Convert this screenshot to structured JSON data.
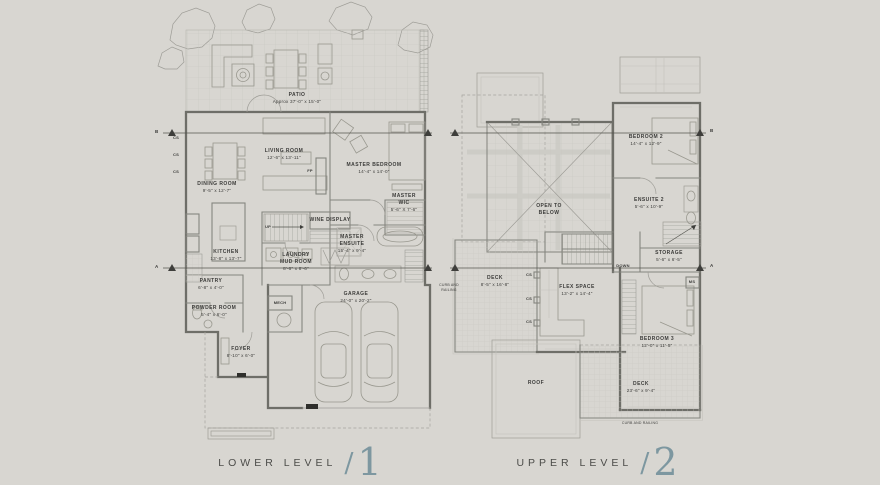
{
  "colors": {
    "background": "#d8d6d1",
    "accent": "#7d97a0",
    "ink": "#3c3c3a",
    "wall": "#6e6e68"
  },
  "titles": {
    "lower": {
      "label": "LOWER LEVEL",
      "separator": "/",
      "number": "1"
    },
    "upper": {
      "label": "UPPER LEVEL",
      "separator": "/",
      "number": "2"
    }
  },
  "lower_level": {
    "rooms": {
      "patio": {
        "name": "PATIO",
        "dims": "Approx 37'-0\" x 15'-0\""
      },
      "living_room": {
        "name": "LIVING ROOM",
        "dims": "12'-6\" x 13'-11\""
      },
      "dining_room": {
        "name": "DINING ROOM",
        "dims": "9'-5\" x 12'-7\""
      },
      "master_bedroom": {
        "name": "MASTER BEDROOM",
        "dims": "14'-4\" x 14'-0\""
      },
      "master_wic": {
        "name": "MASTER\nWIC",
        "dims": "5'-6\" X 7'-6\""
      },
      "kitchen": {
        "name": "KITCHEN",
        "dims": "13'-8\" x 13'-7\""
      },
      "wine_display": {
        "name": "WINE DISPLAY"
      },
      "laundry_mud_room": {
        "name": "LAUNDRY\nMUD ROOM",
        "dims": "8'-6\" x 8'-6\""
      },
      "master_ensuite": {
        "name": "MASTER\nENSUITE",
        "dims": "15'-4\" x 9'-4\""
      },
      "pantry": {
        "name": "PANTRY",
        "dims": "6'-8\" x 4'-0\""
      },
      "powder_room": {
        "name": "POWDER ROOM",
        "dims": "5'-4\" x 6'-0\""
      },
      "garage": {
        "name": "GARAGE",
        "dims": "24'-0\" x 20'-2\""
      },
      "foyer": {
        "name": "FOYER",
        "dims": "8'-10\" x 6'-0\""
      }
    },
    "annotations": {
      "up": "UP",
      "fp": "FP",
      "mech": "MECH",
      "cs": "CS",
      "section_a": "A",
      "section_b": "B"
    }
  },
  "upper_level": {
    "rooms": {
      "bedroom_2": {
        "name": "BEDROOM 2",
        "dims": "14'-4\" x 12'-9\""
      },
      "open_to_below": {
        "name": "OPEN TO\nBELOW"
      },
      "ensuite_2": {
        "name": "ENSUITE 2",
        "dims": "5'-6\" x 10'-9\""
      },
      "storage": {
        "name": "STORAGE",
        "dims": "5'-6\" x 6'-5\""
      },
      "deck_upper": {
        "name": "DECK",
        "dims": "8'-5\" x 16'-8\""
      },
      "flex_space": {
        "name": "FLEX SPACE",
        "dims": "13'-2\" x 14'-4\""
      },
      "bedroom_3": {
        "name": "BEDROOM 3",
        "dims": "12'-0\" x 11'-5\""
      },
      "roof": {
        "name": "ROOF"
      },
      "deck_lower": {
        "name": "DECK",
        "dims": "23'-6\" x 9'-4\""
      }
    },
    "annotations": {
      "down": "DOWN",
      "ms": "MS",
      "cs": "CS",
      "curb_and_railing": "CURB AND\nRAILING",
      "curb_and_railing_bottom": "CURB AND RAILING",
      "section_a": "A",
      "section_b": "B"
    }
  }
}
